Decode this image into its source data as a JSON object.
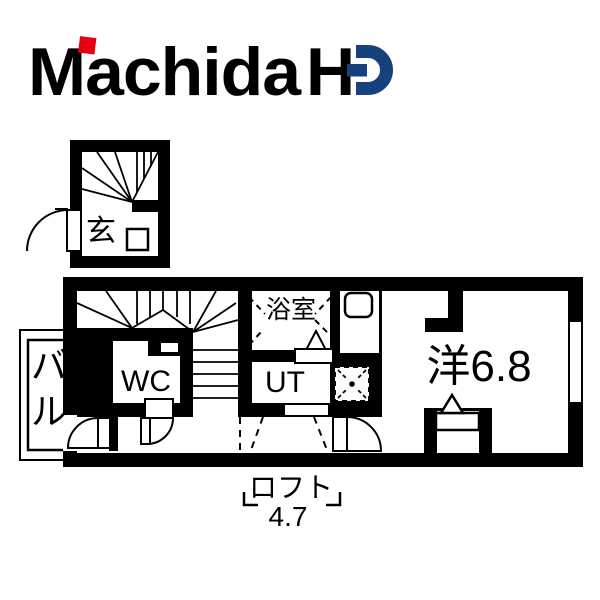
{
  "logo": {
    "brand_word": "Machida",
    "brand_h": "H",
    "brand_d": "D",
    "brand_full": "Machida HD",
    "navy": "#17417E",
    "red": "#E60012"
  },
  "floorplan": {
    "ink": "#000000",
    "entrance_label": "玄",
    "wc_label": "WC",
    "bath_label": "浴室",
    "utility_label": "UT",
    "balcony_label": "バル",
    "balcony_char1": "バ",
    "balcony_char2": "ル",
    "room_label": "洋6.8",
    "loft_label": "ロフト",
    "loft_size": "4.7"
  }
}
